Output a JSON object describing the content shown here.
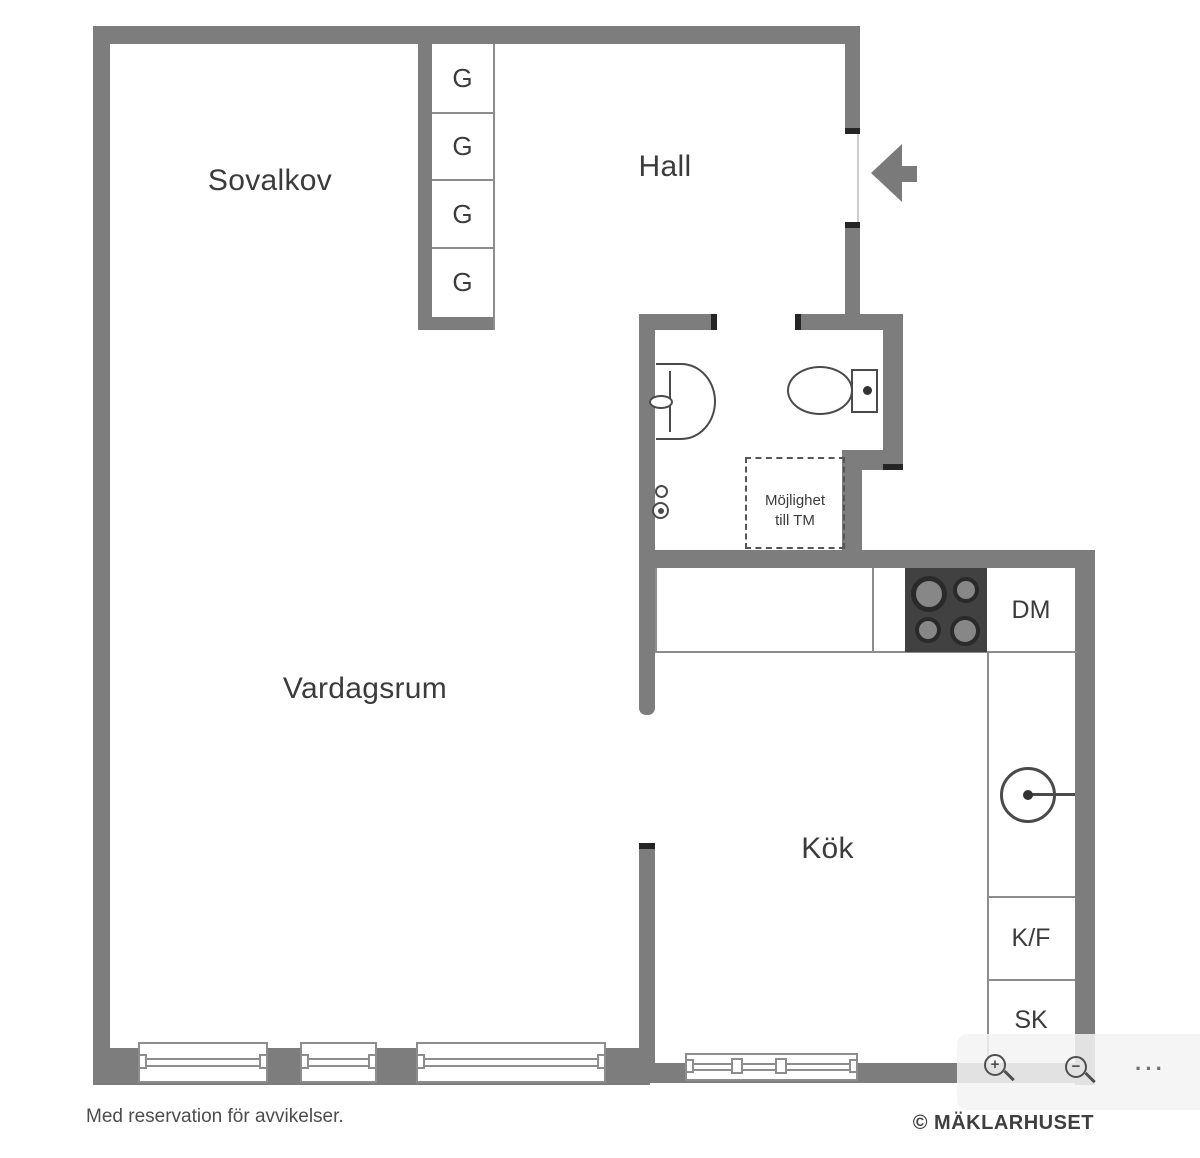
{
  "colors": {
    "wall": "#7d7d7d",
    "wall_cap": "#252525",
    "thin_line": "#8d8d8d",
    "threshold": "#cccccc",
    "fixture_stroke": "#4a4a4a",
    "stove": "#414141",
    "burner_ring": "#2a2a2a",
    "burner_fill": "#878787",
    "label_text": "#3b3b3b",
    "footer_text": "#4c4c4c",
    "entry_arrow": "#7a7a7a",
    "overlay_icon": "#4f4f4f"
  },
  "rooms": {
    "sovalkov": "Sovalkov",
    "hall": "Hall",
    "vardagsrum": "Vardagsrum",
    "kok": "Kök"
  },
  "wardrobes": [
    "G",
    "G",
    "G",
    "G"
  ],
  "kitchen": {
    "dishwasher_label": "DM",
    "fridge_freezer_label": "K/F",
    "cabinet_label": "SK"
  },
  "laundry": {
    "line1": "Möjlighet",
    "line2": "till TM"
  },
  "footer": {
    "disclaimer": "Med reservation för avvikelser.",
    "copyright": "© MÄKLARHUSET"
  },
  "toolbar": {
    "zoom_in": "+",
    "zoom_out": "−",
    "more": "···"
  }
}
